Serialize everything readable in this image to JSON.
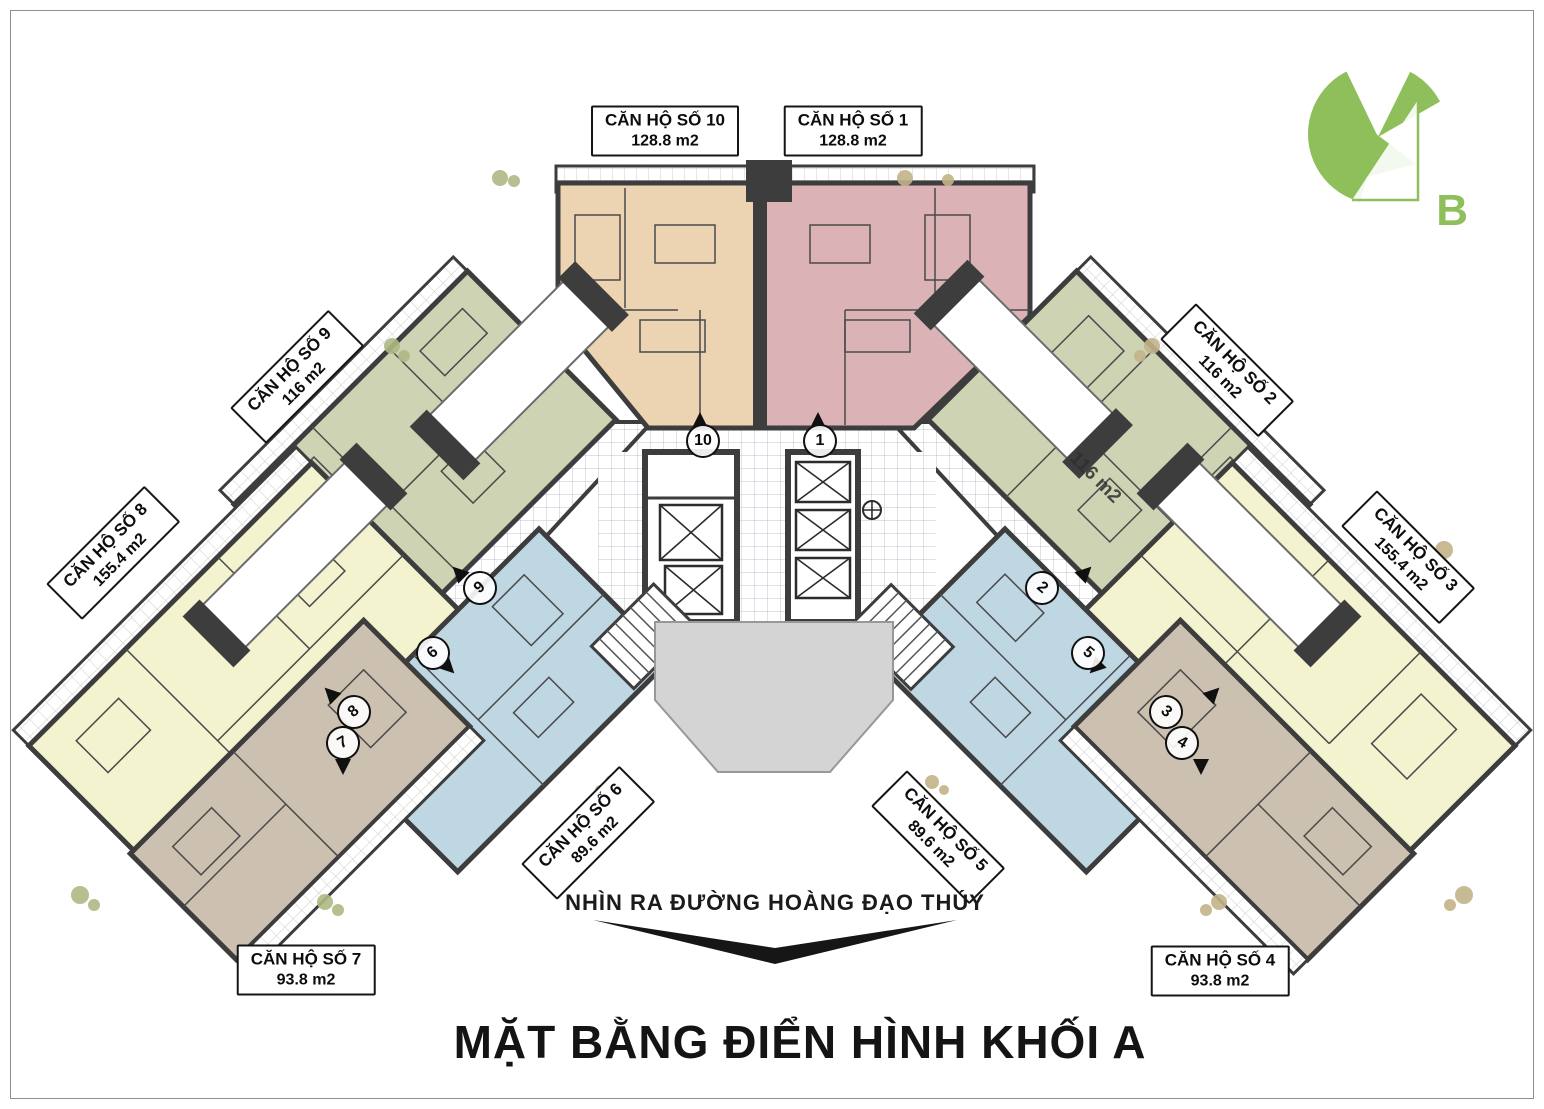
{
  "title": "MẶT BẰNG ĐIỂN HÌNH KHỐI A",
  "street_note": "NHÌN RA ĐƯỜNG HOÀNG ĐẠO THÚY",
  "logo": {
    "letter": "B",
    "color": "#8fbf5b"
  },
  "inplan_annotation": {
    "text": "116 m2"
  },
  "apartments": [
    {
      "id": "10",
      "name": "CĂN HỘ SỐ 10",
      "area": "128.8 m2",
      "color": "#ecd3b2"
    },
    {
      "id": "1",
      "name": "CĂN HỘ SỐ 1",
      "area": "128.8 m2",
      "color": "#dbb2b5"
    },
    {
      "id": "9",
      "name": "CĂN HỘ SỐ 9",
      "area": "116 m2",
      "color": "#ced4b3"
    },
    {
      "id": "2",
      "name": "CĂN HỘ SỐ 2",
      "area": "116 m2",
      "color": "#ced4b3"
    },
    {
      "id": "8",
      "name": "CĂN HỘ SỐ 8",
      "area": "155.4 m2",
      "color": "#f3f3d0"
    },
    {
      "id": "3",
      "name": "CĂN HỘ SỐ 3",
      "area": "155.4 m2",
      "color": "#f3f3d0"
    },
    {
      "id": "6",
      "name": "CĂN HỘ SỐ 6",
      "area": "89.6 m2",
      "color": "#bfd7e3"
    },
    {
      "id": "5",
      "name": "CĂN HỘ SỐ 5",
      "area": "89.6 m2",
      "color": "#bfd7e3"
    },
    {
      "id": "7",
      "name": "CĂN HỘ SỐ 7",
      "area": "93.8 m2",
      "color": "#ccc0b1"
    },
    {
      "id": "4",
      "name": "CĂN HỘ SỐ 4",
      "area": "93.8 m2",
      "color": "#ccc0b1"
    }
  ],
  "unit_markers": [
    {
      "label": "10"
    },
    {
      "label": "1"
    },
    {
      "label": "9"
    },
    {
      "label": "2"
    },
    {
      "label": "6"
    },
    {
      "label": "5"
    },
    {
      "label": "8"
    },
    {
      "label": "3"
    },
    {
      "label": "7"
    },
    {
      "label": "4"
    }
  ],
  "colors": {
    "wall": "#3d3d3d",
    "corridor_tile": "#bcc6cc",
    "balcony_tile": "#cfcfcf",
    "atrium_gray": "#d4d4d4",
    "logo_green": "#8fbf5b"
  }
}
